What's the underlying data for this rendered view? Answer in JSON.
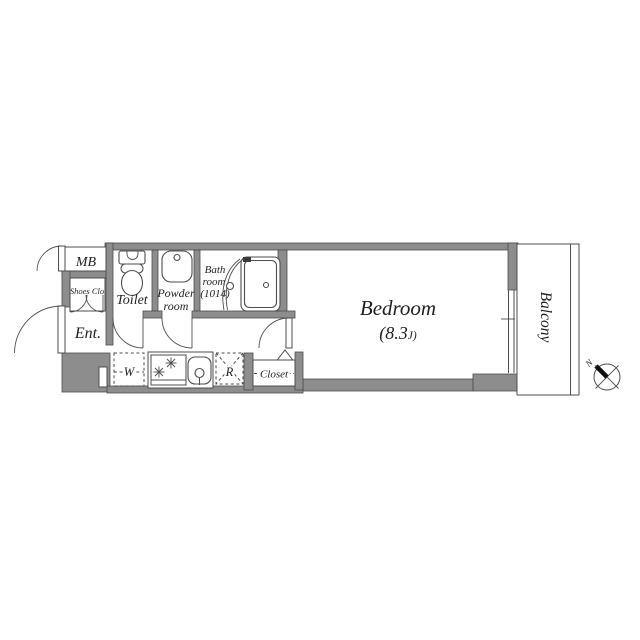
{
  "floorplan": {
    "labels": {
      "mb": "MB",
      "shoes_closet": "Shoes Clo",
      "entrance": "Ent.",
      "toilet": "Toilet",
      "powder_room": [
        "Powder",
        "room"
      ],
      "bath_room": [
        "Bath",
        "room",
        "(1014)"
      ],
      "washer": "W",
      "refrigerator": "R",
      "closet": "Closet",
      "bedroom": "Bedroom",
      "bedroom_size_prefix": "(8.3",
      "bedroom_size_unit": "J)",
      "balcony": "Balcony",
      "compass_north": "N"
    },
    "colors": {
      "wall_fill": "#8d8d8d",
      "wall_outline": "#4d4d4d",
      "line": "#4d4d4d",
      "text": "#1f1f1f",
      "floor": "#ffffff"
    }
  }
}
